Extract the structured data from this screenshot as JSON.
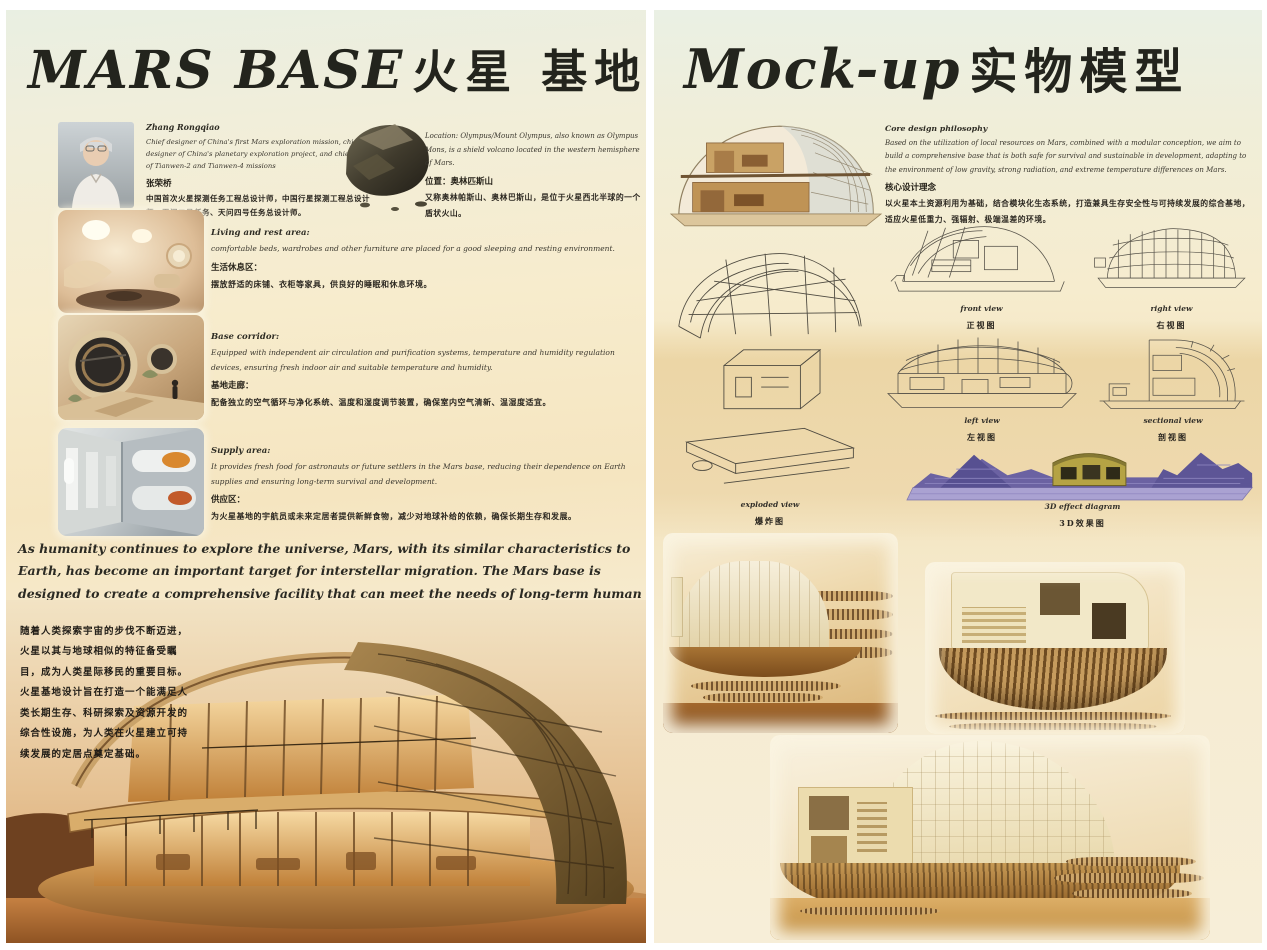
{
  "left_panel": {
    "title_en": "MARS BASE",
    "title_zh": "火星 基地",
    "designer": {
      "name_en": "Zhang Rongqiao",
      "bio_en": "Chief designer of China's first Mars exploration mission, chief designer of China's planetary exploration project, and chief designer of Tianwen-2 and Tianwen-4 missions",
      "name_zh": "张荣桥",
      "bio_zh": "中国首次火星探测任务工程总设计师，中国行星探测工程总设计师，天问二号任务、天问四号任务总设计师。"
    },
    "location": {
      "en": "Location: Olympus/Mount Olympus, also known as Olympus Mons, is a shield volcano located in the western hemisphere of Mars.",
      "zh_label": "位置：奥林匹斯山",
      "zh_desc": "又称奥林帕斯山、奥林巴斯山，是位于火星西北半球的一个盾状火山。"
    },
    "sections": [
      {
        "title_en": "Living and rest area:",
        "body_en": "comfortable beds, wardrobes and other furniture are placed for a good sleeping and resting environment.",
        "title_zh": "生活休息区：",
        "body_zh": "摆放舒适的床铺、衣柜等家具，供良好的睡眠和休息环境。"
      },
      {
        "title_en": "Base corridor:",
        "body_en": "Equipped with independent air circulation and purification systems, temperature and humidity regulation devices, ensuring fresh indoor air and suitable temperature and humidity.",
        "title_zh": "基地走廊：",
        "body_zh": "配备独立的空气循环与净化系统、温度和湿度调节装置，确保室内空气清新、温湿度适宜。"
      },
      {
        "title_en": "Supply area:",
        "body_en": "It provides fresh food for astronauts or future settlers in the Mars base, reducing their dependence on Earth supplies and ensuring long-term survival and development.",
        "title_zh": "供应区：",
        "body_zh": "为火星基地的宇航员或未来定居者提供新鲜食物，减少对地球补给的依赖，确保长期生存和发展。"
      }
    ],
    "intro_en": "As humanity continues to explore the universe, Mars, with its similar characteristics to Earth, has become an important target for interstellar migration. The Mars base is designed to create a comprehensive facility that can meet the needs of long-term human survival, scientific research and exploration, and resource development, laying the foundation for the establishment of a sustainable settlement on Mars.",
    "intro_zh": "随着人类探索宇宙的步伐不断迈进，火星以其与地球相似的特征备受瞩目，成为人类星际移民的重要目标。火星基地设计旨在打造一个能满足人类长期生存、科研探索及资源开发的综合性设施，为人类在火星建立可持续发展的定居点奠定基础。"
  },
  "right_panel": {
    "title_en": "Mock-up",
    "title_zh": "实物模型",
    "philosophy": {
      "title_en": "Core design philosophy",
      "body_en": "Based on the utilization of local resources on Mars, combined with a modular conception, we aim to build a comprehensive base that is both safe for survival and sustainable in development, adapting to the environment of low gravity, strong radiation, and extreme temperature differences on Mars.",
      "title_zh": "核心设计理念",
      "body_zh": "以火星本土资源利用为基础，结合模块化生态系统，打造兼具生存安全性与可持续发展的综合基地，适应火星低重力、强辐射、极端温差的环境。"
    },
    "views": [
      {
        "en": "front view",
        "zh": "正视图"
      },
      {
        "en": "right view",
        "zh": "右视图"
      },
      {
        "en": "left view",
        "zh": "左视图"
      },
      {
        "en": "sectional view",
        "zh": "剖视图"
      }
    ],
    "exploded_label_en": "exploded view",
    "exploded_label_zh": "爆炸图",
    "effect_label_en": "3D effect diagram",
    "effect_label_zh": "3D效果图"
  },
  "colors": {
    "panel_top_green": "#eaf0e4",
    "panel_cream": "#f6ecce",
    "sand_band": "#ecd6a6",
    "terrain_purple": "#7f76b4",
    "render_amber": "#d28a45"
  }
}
